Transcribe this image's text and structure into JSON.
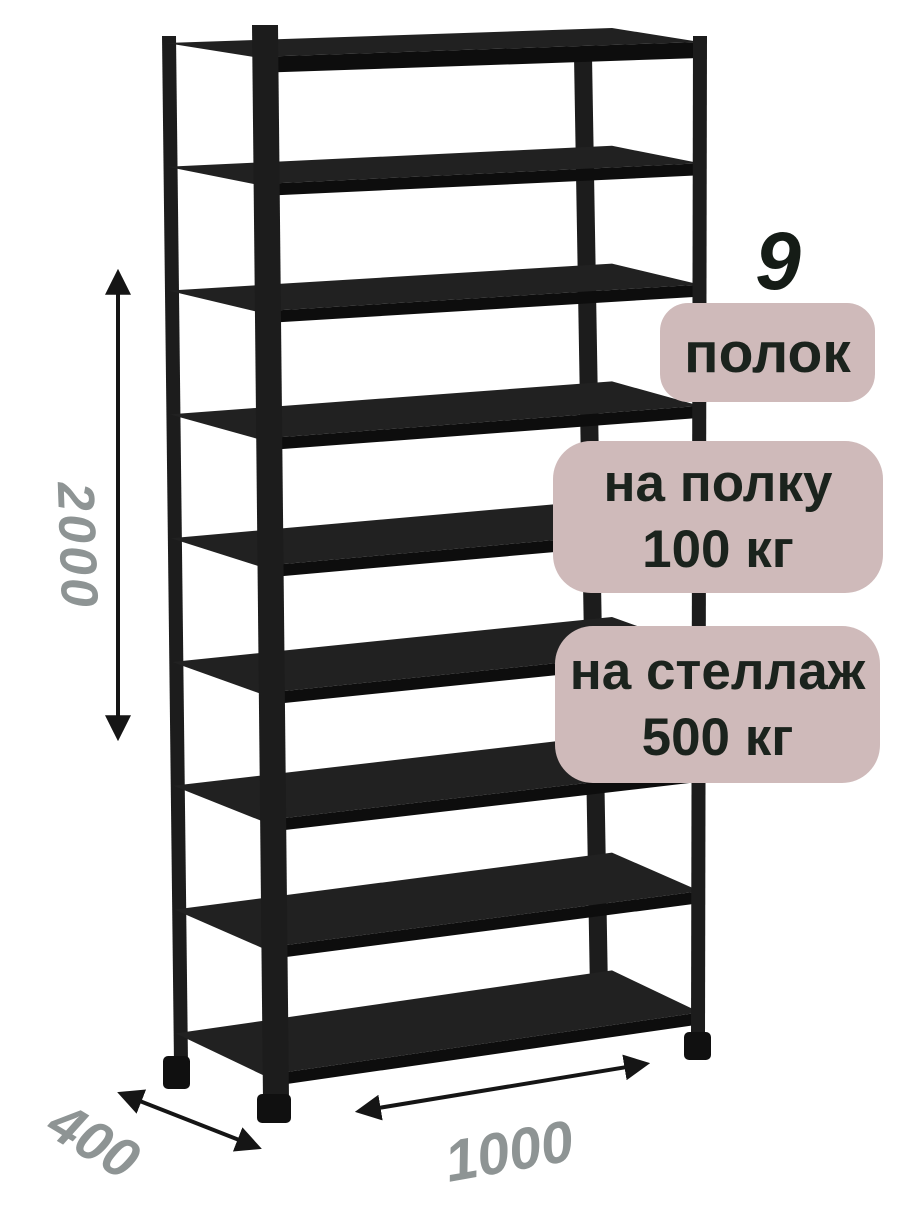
{
  "annotations": {
    "shelf_count": {
      "number": "9",
      "label": "полок"
    },
    "shelf_load": {
      "line1": "на полку",
      "line2": "100 кг"
    },
    "rack_load": {
      "line1": "на стеллаж",
      "line2": "500 кг"
    }
  },
  "dimensions": {
    "height_mm": "2000",
    "depth_mm": "400",
    "width_mm": "1000"
  },
  "colors": {
    "badge-bg": "#cfbaba",
    "badge-text": "#1b231d",
    "dim-text": "#8e9494",
    "metal": "#1c1c1c",
    "shelf-top": "#212121",
    "shelf-lip": "#0d0d0d",
    "arrow": "#151515"
  }
}
